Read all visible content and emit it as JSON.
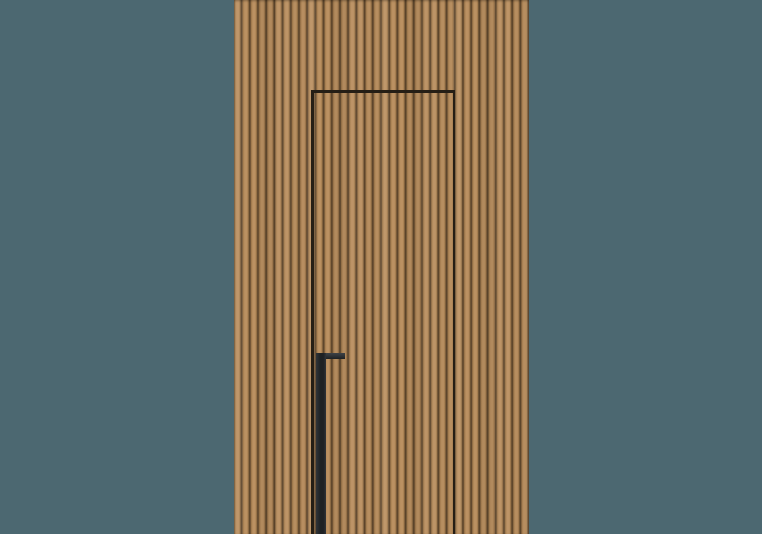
{
  "scene": {
    "type": "product-render",
    "description": "Concealed flush interior door clad in vertical wood slats, with a dark recessed vertical pull handle, centered on a plain teal-gray backdrop",
    "elements": [
      {
        "name": "backdrop",
        "label": "plain teal studio background"
      },
      {
        "name": "wood-slat-panel",
        "label": "wall panel of narrow vertical oak slats"
      },
      {
        "name": "door-seam-outline",
        "label": "thin dark seam outlining the hidden door, open at the bottom edge"
      },
      {
        "name": "pull-handle",
        "label": "black L-profile pull handle running from mid-height to the floor"
      }
    ]
  },
  "colors": {
    "backdrop": "#4c6871",
    "wood_face_light": "#bb9162",
    "wood_face_mid": "#a67e50",
    "wood_groove": "#6d5234",
    "wood_groove_dark": "#553f27",
    "door_seam": "#251e15",
    "handle_dark": "#1e2124",
    "handle_mid": "#303438",
    "handle_light": "#3e4246"
  }
}
